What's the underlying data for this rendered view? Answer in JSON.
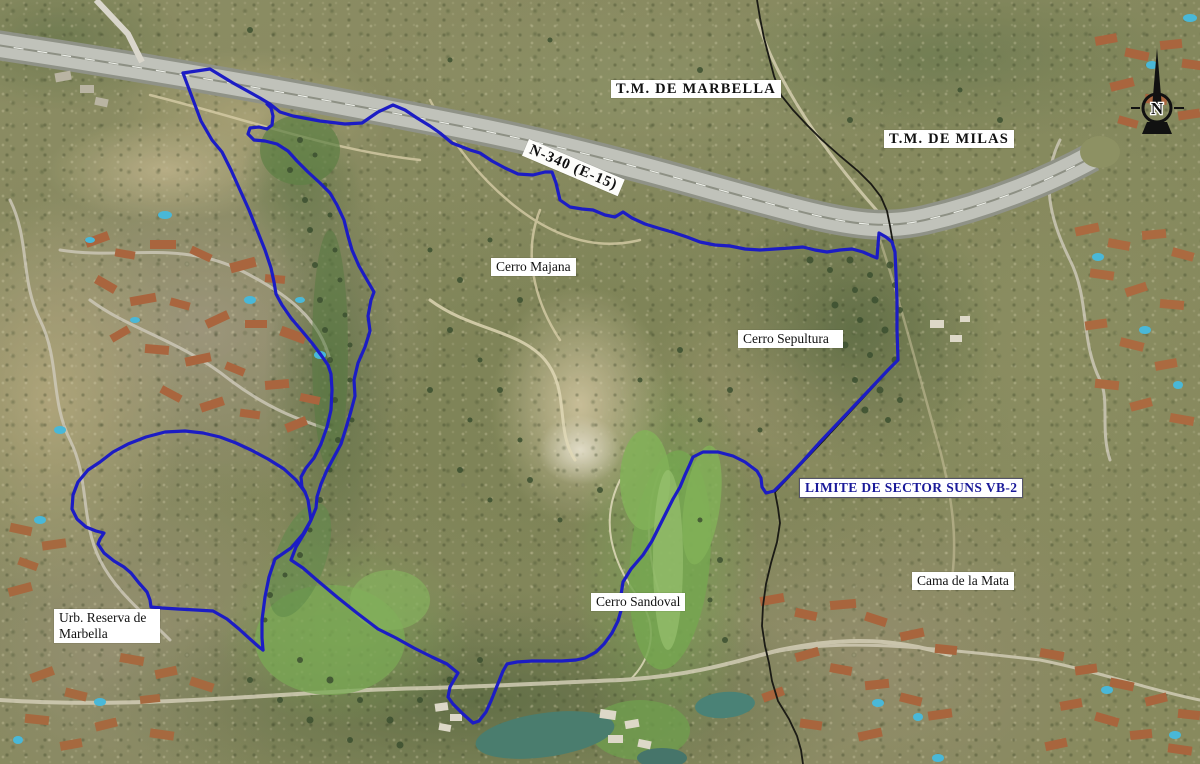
{
  "map": {
    "region_labels": {
      "tm_marbella": "T.M. DE MARBELLA",
      "tm_milas": "T.M. DE MILAS"
    },
    "road_label": "N-340 (E-15)",
    "place_labels": {
      "cerro_majana": "Cerro Majana",
      "cerro_sepultura": "Cerro Sepultura",
      "cerro_sandoval": "Cerro Sandoval",
      "cama_de_la_mata": "Cama de la Mata"
    },
    "urbanization_label": {
      "line1": "Urb. Reserva de",
      "line2": "Marbella"
    },
    "sector_boundary_label": "LIMITE DE SECTOR SUNS VB-2",
    "compass": {
      "north_letter": "N"
    }
  },
  "colors": {
    "boundary-blue": "#1c1cc4",
    "sector-label-blue": "#1a1a99",
    "municipal-line-black": "#1b1b15",
    "highway-gray": "#c0c2ba",
    "label-bg": "#ffffff",
    "label-text": "#111111"
  }
}
